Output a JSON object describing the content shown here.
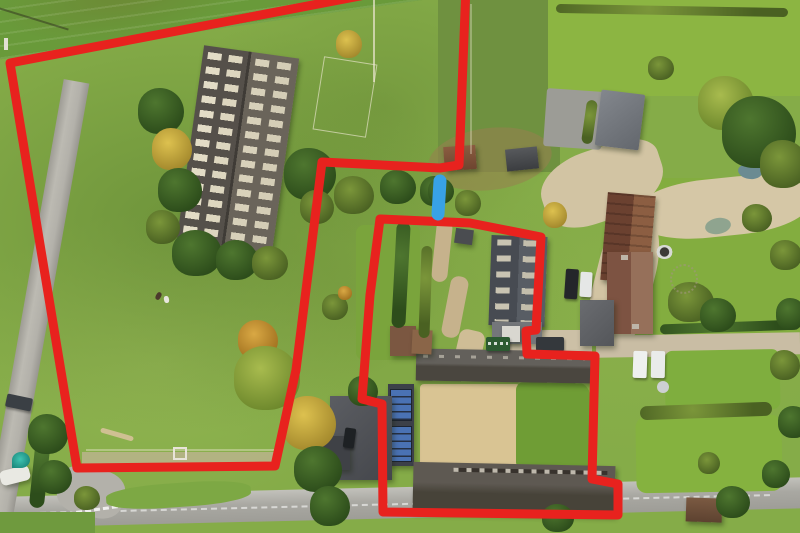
{
  "scene": {
    "type": "aerial-photograph",
    "description": "Drone aerial view of a rural smallholding: a large grass field with a long agricultural barn on the left, a farmstead with courtyard barns, farmhouse and gardens on the right, a country lane on the left and a main road along the bottom. Two plots are outlined with thick red boundary lines and a short blue bar marks an access point between them.",
    "season": "autumn",
    "colors": {
      "boundary_red": "#e8221e",
      "marker_blue": "#38a2e6",
      "field_green": "#85ac48",
      "lawn_bright": "#8cb542",
      "gravel_beige": "#d3c5a4",
      "road_grey": "#adaca6",
      "courtyard_sand": "#d9c493"
    }
  },
  "features": [
    {
      "name": "large-agricultural-barn",
      "note": "long dark roof with grid of pale skylights, left field"
    },
    {
      "name": "farmhouse",
      "note": "brick-red roof, right of centre"
    },
    {
      "name": "skylight-barn",
      "note": "slate roof with pale rooflights, centre"
    },
    {
      "name": "south-barn-range",
      "note": "long weathered roof along bottom of right plot"
    },
    {
      "name": "solar-roof",
      "note": "blue photovoltaic panels on outbuilding"
    },
    {
      "name": "sand-courtyard",
      "note": "tan yard inside right plot"
    },
    {
      "name": "gravel-driveway",
      "note": "sweeping beige drive, top right"
    },
    {
      "name": "country-lane",
      "note": "narrow lane, left edge"
    },
    {
      "name": "main-road",
      "note": "grey road along bottom with white centre dashes"
    }
  ],
  "annotations": {
    "stroke_width": 9,
    "plots": [
      {
        "id": "plot-a-left-field",
        "closed": true,
        "points": [
          [
            412,
            -14
          ],
          [
            10,
            63
          ],
          [
            77,
            468
          ],
          [
            275,
            466
          ],
          [
            296,
            370
          ],
          [
            322,
            162
          ],
          [
            440,
            168
          ],
          [
            459,
            165
          ],
          [
            466,
            -14
          ]
        ]
      },
      {
        "id": "plot-b-farmstead",
        "closed": true,
        "points": [
          [
            380,
            219
          ],
          [
            470,
            223
          ],
          [
            541,
            237
          ],
          [
            536,
            330
          ],
          [
            526,
            331
          ],
          [
            527,
            354
          ],
          [
            595,
            356
          ],
          [
            592,
            479
          ],
          [
            618,
            484
          ],
          [
            618,
            515
          ],
          [
            383,
            512
          ],
          [
            382,
            404
          ],
          [
            362,
            399
          ],
          [
            370,
            295
          ]
        ]
      }
    ],
    "access_marker": {
      "id": "blue-access-bar",
      "x1": 440,
      "y1": 181,
      "x2": 438,
      "y2": 214,
      "stroke_width": 13
    }
  }
}
